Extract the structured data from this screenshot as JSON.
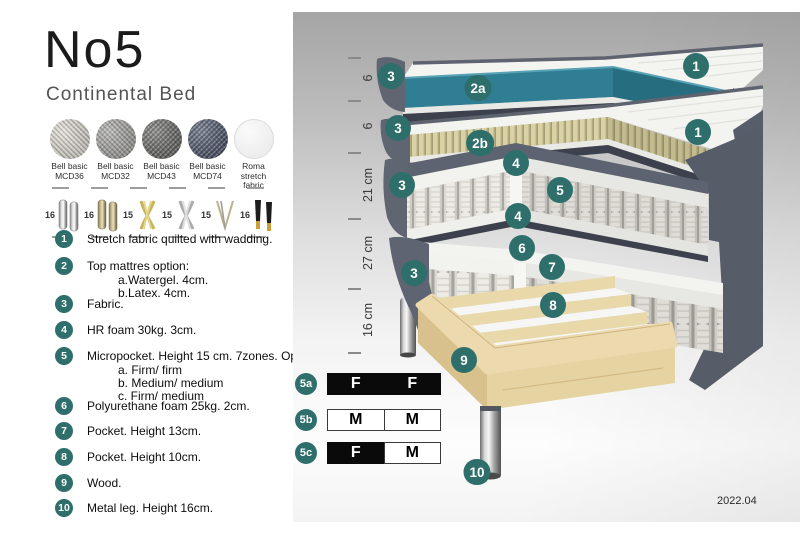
{
  "header": {
    "title": "No5",
    "subtitle": "Continental Bed"
  },
  "colors": {
    "accent_teal": "#2e6f6b",
    "core_teal": "#2f7e93",
    "fabric_slate": "#5b6170",
    "latex": "#d9d2a4",
    "wood": "#ecdaae"
  },
  "fabrics": [
    {
      "line1": "Bell basic",
      "line2": "MCD36"
    },
    {
      "line1": "Bell basic",
      "line2": "MCD32"
    },
    {
      "line1": "Bell basic",
      "line2": "MCD43"
    },
    {
      "line1": "Bell basic",
      "line2": "MCD74"
    },
    {
      "line1": "Roma",
      "line2": "stretch fabric"
    }
  ],
  "legs": [
    {
      "size": "16",
      "icon": "cylinder-silver-leg"
    },
    {
      "size": "16",
      "icon": "cylinder-brass-leg"
    },
    {
      "size": "15",
      "icon": "cross-gold-leg"
    },
    {
      "size": "15",
      "icon": "cross-silver-leg"
    },
    {
      "size": "15",
      "icon": "hairpin-leg"
    },
    {
      "size": "16",
      "icon": "tapered-black-gold-leg"
    }
  ],
  "list": [
    {
      "num": "1",
      "text": "Stretch fabric quilted with wadding."
    },
    {
      "num": "2",
      "text": "Top mattres option:",
      "subs": [
        "a.Watergel. 4cm.",
        "b.Latex. 4cm."
      ]
    },
    {
      "num": "3",
      "text": "Fabric."
    },
    {
      "num": "4",
      "text": "HR foam 30kg. 3cm."
    },
    {
      "num": "5",
      "text": "Micropocket. Height 15 cm. 7zones. Option:",
      "subs": [
        "a. Firm/ firm",
        "b. Medium/ medium",
        "c. Firm/ medium"
      ]
    },
    {
      "num": "6",
      "text": "Polyurethane foam 25kg. 2cm."
    },
    {
      "num": "7",
      "text": "Pocket. Height 13cm."
    },
    {
      "num": "8",
      "text": "Pocket. Height 10cm."
    },
    {
      "num": "9",
      "text": "Wood."
    },
    {
      "num": "10",
      "text": "Metal leg. Height 16cm."
    }
  ],
  "diagram": {
    "ruler": [
      "6",
      "6",
      "21 cm",
      "27 cm",
      "16 cm"
    ],
    "callouts": {
      "c1a": "1",
      "c1b": "1",
      "c2a": "2a",
      "c2b": "2b",
      "c3a": "3",
      "c3b": "3",
      "c3c": "3",
      "c3d": "3",
      "c4a": "4",
      "c4b": "4",
      "c5": "5",
      "c6": "6",
      "c7": "7",
      "c8": "8",
      "c9": "9",
      "c10": "10"
    }
  },
  "options": {
    "rows": [
      {
        "badge": "5a",
        "c1": "F",
        "c2": "F"
      },
      {
        "badge": "5b",
        "c1": "M",
        "c2": "M"
      },
      {
        "badge": "5c",
        "c1": "F",
        "c2": "M"
      }
    ]
  },
  "version": "2022.04"
}
